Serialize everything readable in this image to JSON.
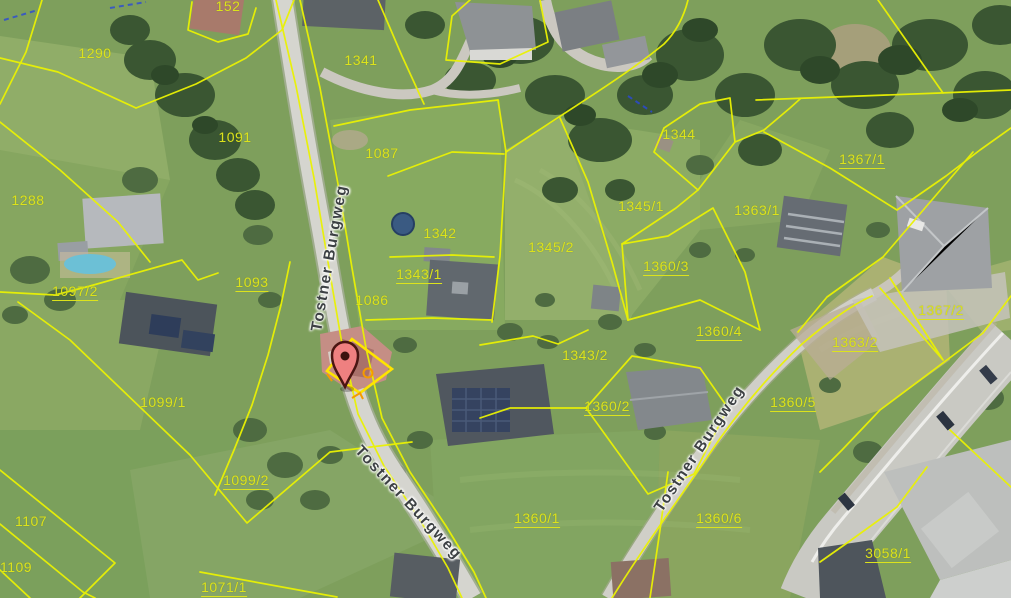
{
  "map": {
    "kind": "aerial-cadastral-map",
    "street_labels": [
      {
        "text": "Tostner Burgweg",
        "x": 330,
        "y": 258,
        "rotation": -80
      },
      {
        "text": "Tostner Burgweg",
        "x": 408,
        "y": 503,
        "rotation": 47
      },
      {
        "text": "Tostner Burgweg",
        "x": 700,
        "y": 449,
        "rotation": -56
      }
    ],
    "parcel_labels": [
      {
        "t": "152",
        "x": 228,
        "y": 6,
        "u": 0
      },
      {
        "t": "1290",
        "x": 95,
        "y": 53,
        "u": 0
      },
      {
        "t": "1341",
        "x": 361,
        "y": 60,
        "u": 0
      },
      {
        "t": "1091",
        "x": 235,
        "y": 137,
        "u": 0
      },
      {
        "t": "1344",
        "x": 679,
        "y": 134,
        "u": 0
      },
      {
        "t": "1087",
        "x": 382,
        "y": 153,
        "u": 0
      },
      {
        "t": "1367/1",
        "x": 862,
        "y": 160,
        "u": 1
      },
      {
        "t": "1288",
        "x": 28,
        "y": 200,
        "u": 0
      },
      {
        "t": "1345/1",
        "x": 641,
        "y": 206,
        "u": 0
      },
      {
        "t": "1363/1",
        "x": 757,
        "y": 210,
        "u": 0
      },
      {
        "t": "1342",
        "x": 440,
        "y": 233,
        "u": 0
      },
      {
        "t": "1345/2",
        "x": 551,
        "y": 247,
        "u": 0
      },
      {
        "t": "1360/3",
        "x": 666,
        "y": 267,
        "u": 1
      },
      {
        "t": "1343/1",
        "x": 419,
        "y": 275,
        "u": 1
      },
      {
        "t": "1093",
        "x": 252,
        "y": 283,
        "u": 1
      },
      {
        "t": "1097/2",
        "x": 75,
        "y": 292,
        "u": 1
      },
      {
        "t": "1086",
        "x": 372,
        "y": 300,
        "u": 0
      },
      {
        "t": "1367/2",
        "x": 941,
        "y": 311,
        "u": 1
      },
      {
        "t": "1360/4",
        "x": 719,
        "y": 332,
        "u": 1
      },
      {
        "t": "1363/2",
        "x": 855,
        "y": 343,
        "u": 1
      },
      {
        "t": "1343/2",
        "x": 585,
        "y": 355,
        "u": 0
      },
      {
        "t": "1099/1",
        "x": 163,
        "y": 402,
        "u": 0
      },
      {
        "t": "1360/5",
        "x": 793,
        "y": 403,
        "u": 1
      },
      {
        "t": "1360/2",
        "x": 607,
        "y": 407,
        "u": 1
      },
      {
        "t": "1099/2",
        "x": 246,
        "y": 481,
        "u": 1
      },
      {
        "t": "1360/1",
        "x": 537,
        "y": 519,
        "u": 1
      },
      {
        "t": "1360/6",
        "x": 719,
        "y": 519,
        "u": 1
      },
      {
        "t": "1107",
        "x": 31,
        "y": 521,
        "u": 0
      },
      {
        "t": "3058/1",
        "x": 888,
        "y": 554,
        "u": 1
      },
      {
        "t": "1109",
        "x": 16,
        "y": 567,
        "u": 0
      },
      {
        "t": "1071/1",
        "x": 224,
        "y": 588,
        "u": 1
      }
    ],
    "marker": {
      "x": 344,
      "y": 387,
      "fill": "#ef8080",
      "stroke": "#4a1512",
      "dot": "#3c120e"
    },
    "colors": {
      "parcel_line": "#eaf203",
      "parcel_text": "#dce31c",
      "selection": "#ffe400",
      "selection_accent": "#f59b00",
      "street_text": "#3d4144"
    }
  }
}
